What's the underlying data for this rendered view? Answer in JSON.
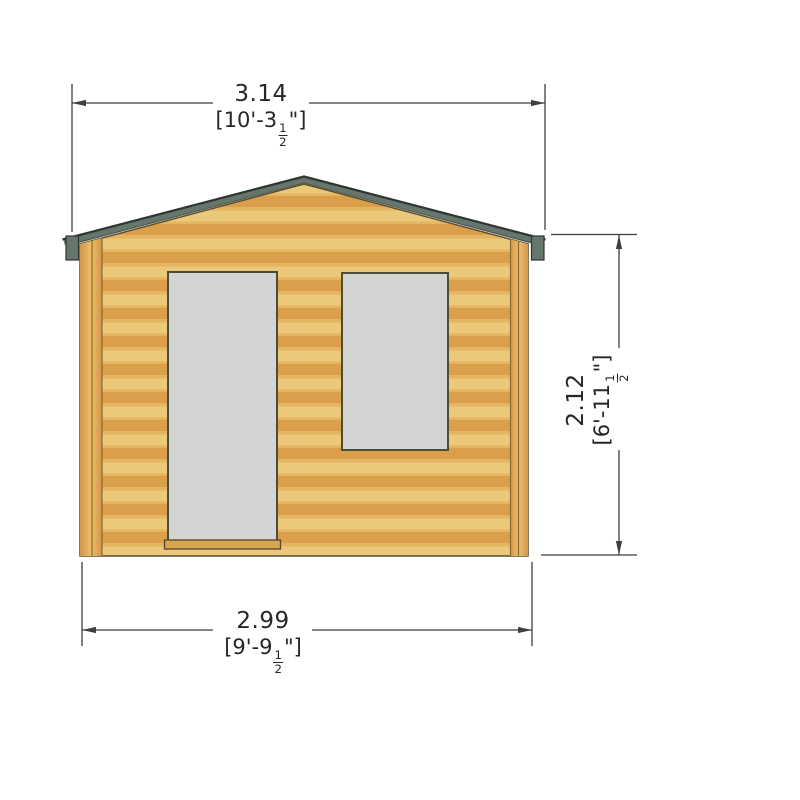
{
  "title": "Log cabin front elevation with dimensions",
  "dimensions": {
    "overall_width": {
      "metric": "3.14",
      "imperial_prefix": "[10'-3",
      "fraction_numerator": "1",
      "fraction_denominator": "2",
      "imperial_suffix": "\"]"
    },
    "wall_height": {
      "metric": "2.12",
      "imperial_prefix": "[6'-11",
      "fraction_numerator": "1",
      "fraction_denominator": "2",
      "imperial_suffix": "\"]"
    },
    "base_width": {
      "metric": "2.99",
      "imperial_prefix": "[9'-9",
      "fraction_numerator": "1",
      "fraction_denominator": "2",
      "imperial_suffix": "\"]"
    }
  },
  "building": {
    "parts": [
      "gable-roof",
      "log-wall",
      "left-corner-post",
      "right-corner-post",
      "door",
      "window",
      "door-threshold"
    ]
  },
  "colors": {
    "wood_light": "#ecc87a",
    "wood_dark": "#db9e4a",
    "wood_mid": "#e5b562",
    "post_light": "#ecbf6a",
    "post_dark": "#d4954a",
    "post_seam": "#8a6a30",
    "roof": "#66766d",
    "roof_edge": "#2e3632",
    "frame": "#4c4c38",
    "glass": "#d3d5d2",
    "threshold": "#d7a54e",
    "outline": "#5a4e2c",
    "dim_line": "#3f3f3f"
  }
}
